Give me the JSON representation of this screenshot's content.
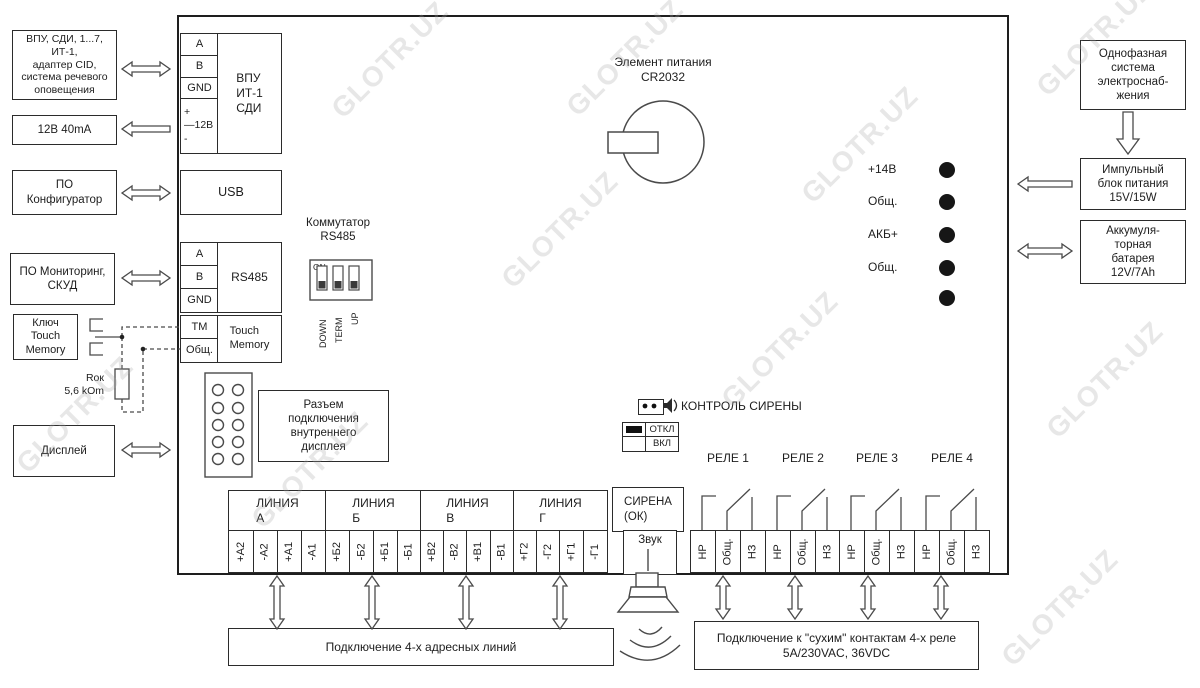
{
  "watermark": {
    "text": "GLOTR.UZ"
  },
  "external_left": {
    "devices": "ВПУ, СДИ, 1...7,\nИТ-1,\nадаптер CID,\nсистема речевого\nоповещения",
    "power_out": "12В 40mA",
    "configurator": "ПО\nКонфигуратор",
    "monitoring": "ПО Мониторинг,\nСКУД",
    "touch_key": "Ключ\nTouch\nMemory",
    "resistor": "Rок\n5,6 kOm",
    "display": "Дисплей"
  },
  "external_right": {
    "mains": "Однофазная\nсистема\nэлектроснаб-\nжения",
    "psu": "Импульный\nблок питания\n15V/15W",
    "battery": "Аккумуля-\nторная\nбатарея\n12V/7Ah"
  },
  "board": {
    "vpu_terminals": [
      "A",
      "B",
      "GND"
    ],
    "vpu_power": "+\n—12В\n-",
    "vpu_label": "ВПУ\nИТ-1\nСДИ",
    "usb": "USB",
    "rs485_terminals": [
      "A",
      "B",
      "GND"
    ],
    "rs485_label": "RS485",
    "tm_terminals": [
      "TM",
      "Общ."
    ],
    "tm_label": "Touch\nMemory",
    "switch_title": "Коммутатор\nRS485",
    "switch_on": "ON",
    "switch_positions": [
      "DOWN",
      "TERM",
      "UP"
    ],
    "battery_label": "Элемент питания\nCR2032",
    "led_labels": [
      "+14В",
      "Общ.",
      "АКБ+",
      "Общ."
    ],
    "display_connector": "Разъем\nподключения\nвнутреннего\nдисплея",
    "siren_control": {
      "title": "КОНТРОЛЬ СИРЕНЫ",
      "off": "ОТКЛ",
      "on": "ВКЛ"
    },
    "relay_titles": [
      "РЕЛЕ 1",
      "РЕЛЕ 2",
      "РЕЛЕ 3",
      "РЕЛЕ 4"
    ],
    "relay_contacts": [
      "НР",
      "Общ.",
      "НЗ"
    ],
    "lines": [
      {
        "title": "ЛИНИЯ\nА",
        "terminals": [
          "+А2",
          "-А2",
          "+А1",
          "-А1"
        ]
      },
      {
        "title": "ЛИНИЯ\nБ",
        "terminals": [
          "+Б2",
          "-Б2",
          "+Б1",
          "-Б1"
        ]
      },
      {
        "title": "ЛИНИЯ\nВ",
        "terminals": [
          "+В2",
          "-В2",
          "+В1",
          "-В1"
        ]
      },
      {
        "title": "ЛИНИЯ\nГ",
        "terminals": [
          "+Г2",
          "-Г2",
          "+Г1",
          "-Г1"
        ]
      }
    ],
    "siren": {
      "title": "СИРЕНА\n(ОК)",
      "terminal": "Звук"
    }
  },
  "bottom": {
    "lines_note": "Подключение 4-х адресных линий",
    "relay_note": "Подключение к \"сухим\" контактам 4-х реле\n5А/230VAC, 36VDC"
  }
}
